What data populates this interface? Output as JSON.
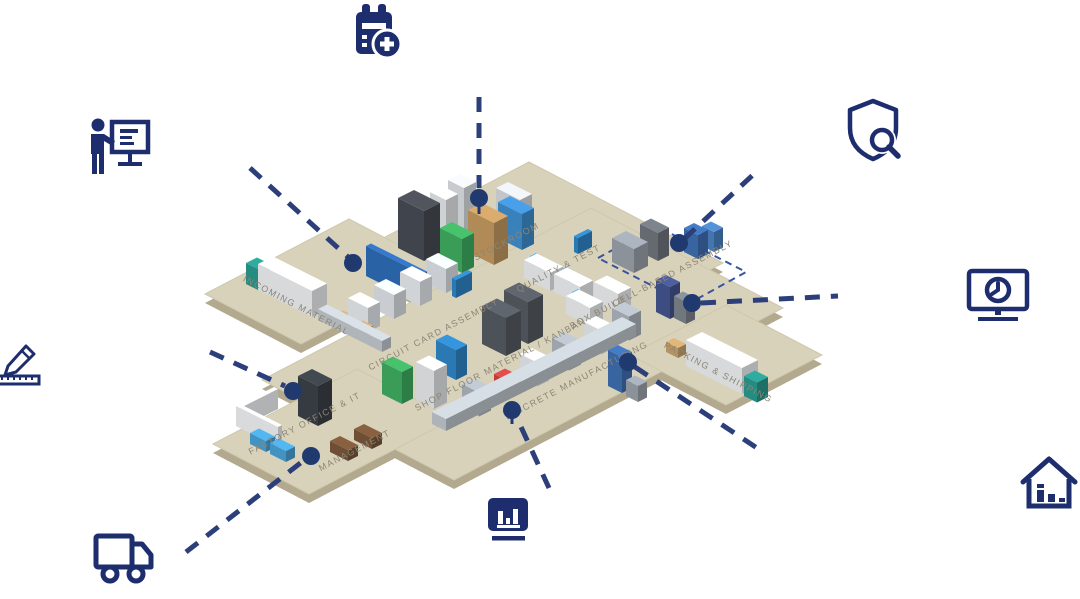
{
  "title": "Smart factory overview map",
  "colors": {
    "icon_navy": "#1d2d6e",
    "dash_navy": "#2c3f7a",
    "dot_navy": "#20396f",
    "floor_top": "#d9d2bb",
    "floor_side": "#b2a98e",
    "zone_label": "#8c8575",
    "zone_outline_blue": "#38549e",
    "truck_teal": "#2a9a8f",
    "bin_green": "#3fae62",
    "bin_blue": "#2f86c8"
  },
  "icons": [
    {
      "id": "calendar-add-icon"
    },
    {
      "id": "presenter-training-icon"
    },
    {
      "id": "design-pencil-ruler-icon"
    },
    {
      "id": "delivery-truck-icon"
    },
    {
      "id": "production-chart-icon"
    },
    {
      "id": "home-analytics-icon"
    },
    {
      "id": "monitor-clock-icon"
    },
    {
      "id": "shield-inspection-icon"
    }
  ],
  "zones": {
    "stockroom": {
      "label": "STOCKROOM"
    },
    "quality": {
      "label": "QUALITY & TEST"
    },
    "cell": {
      "label": "CELL-BASED ASSEMBLY"
    },
    "incoming": {
      "label": "INCOMING MATERIAL"
    },
    "cca": {
      "label": "CIRCUIT CARD ASSEMBLY"
    },
    "shopfloor": {
      "label": "SHOP FLOOR MATERIAL / KANBAN"
    },
    "boxbuild": {
      "label": "BOX BUILD"
    },
    "discrete": {
      "label": "DISCRETE MANUFACTURING"
    },
    "office": {
      "label": "FACTORY OFFICE & IT"
    },
    "management": {
      "label": "MANAGEMENT"
    },
    "packing": {
      "label": "PACKING & SHIPPING"
    }
  }
}
